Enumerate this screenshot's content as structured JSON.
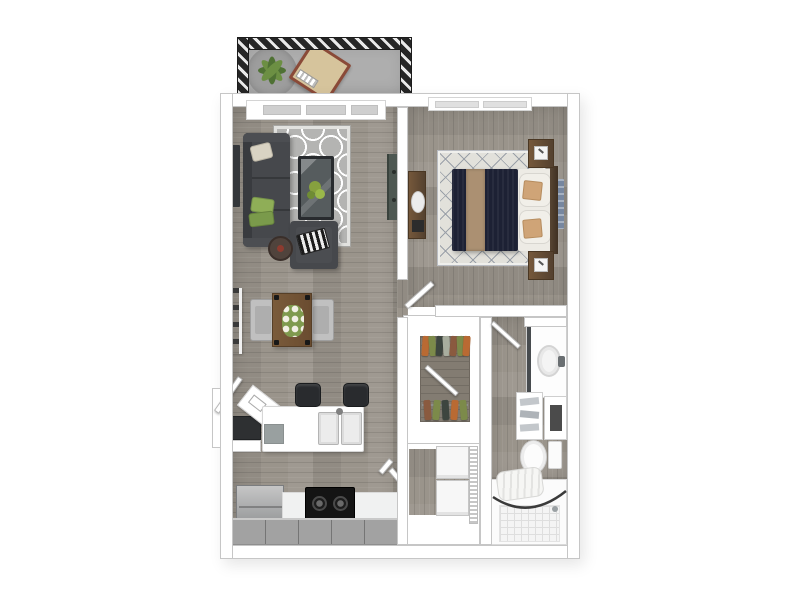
{
  "palette": {
    "wall": "#ffffff",
    "wall_line": "#c6c6c6",
    "floor_wood": "#9a948b",
    "floor_closet": "#837c72",
    "balcony_floor": "#aeaeae",
    "patio_rug": "#9d9d9d",
    "railing": "#262626",
    "railing_slash": "#e9e9e9",
    "lounge_tan": "#d6c49c",
    "lounge_frame": "#8a4a38",
    "plant_green": "#4f7134",
    "plant_green_light": "#6c8f43",
    "rug_living": "#b4b4b2",
    "rug_living_pattern": "#ffffff",
    "rug_bed": "#e2e1db",
    "rug_bed_line": "#9aa0a8",
    "sofa": "#46484c",
    "sofa_dark": "#393b3f",
    "pillow_cream": "#d9d3c3",
    "pillow_green": "#8fae57",
    "pillow_green_dark": "#7a9a4b",
    "stripe_dark": "#1b1b1b",
    "stripe_light": "#ececec",
    "glass_table": "#565c5e",
    "table_frame": "#282b2e",
    "side_table": "#50433c",
    "accent_red": "#8d3b2f",
    "tv_console": "#4e5852",
    "art_dark": "#34373b",
    "art_blue": "#7787a0",
    "wood_brown": "#75583b",
    "wood_dark": "#54412f",
    "chair_gray": "#c0c0c0",
    "duvet_navy": "#1d2134",
    "runner_tan": "#ab9072",
    "sheet_white": "#edebe5",
    "pillow_tan": "#cfa477",
    "cabinet_gray": "#a2a2a2",
    "counter_white": "#f0f1f1",
    "appliance_dark": "#141414",
    "appliance_gray": "#9fa1a3",
    "fixture": "#fbfbfb",
    "fixture_line": "#cfcfcf",
    "tile": "#f4f4f4",
    "tile_line": "#dedede",
    "towel": "#c3c7cb",
    "cloth_orange": "#b96a33",
    "cloth_green": "#7c8a4a",
    "cloth_dark": "#3d453f",
    "cloth_light": "#a8ad9e",
    "cloth_brown": "#8a5a3f",
    "rod": "#3a3a3a"
  },
  "scene": {
    "type": "3d-floor-plan-render",
    "rooms": {
      "balcony": {
        "label": "Balcony"
      },
      "living_room": {
        "label": "Living Room"
      },
      "dining_area": {
        "label": "Dining Area"
      },
      "kitchen": {
        "label": "Kitchen"
      },
      "bedroom": {
        "label": "Bedroom"
      },
      "closet": {
        "label": "Closet"
      },
      "laundry": {
        "label": "Laundry Closet"
      },
      "bathroom": {
        "label": "Bathroom"
      }
    },
    "furniture": {
      "sofa": {
        "label": "Sofa"
      },
      "accent_chair": {
        "label": "Accent Chair"
      },
      "coffee_table": {
        "label": "Coffee Table"
      },
      "side_table": {
        "label": "Side Table"
      },
      "living_rug": {
        "label": "Living Room Rug"
      },
      "media_console": {
        "label": "Media Console"
      },
      "wall_art": {
        "label": "Wall Art"
      },
      "dining_table": {
        "label": "Dining Table"
      },
      "dining_chair": {
        "label": "Dining Chair"
      },
      "ladder_shelf": {
        "label": "Ladder Shelf"
      },
      "bar_stool": {
        "label": "Bar Stool"
      },
      "kitchen_counter": {
        "label": "Kitchen Counter with Double Sink"
      },
      "refrigerator": {
        "label": "Refrigerator"
      },
      "range": {
        "label": "Range"
      },
      "base_cabinets": {
        "label": "Base Cabinets"
      },
      "bed": {
        "label": "Bed"
      },
      "nightstand": {
        "label": "Nightstand"
      },
      "dresser": {
        "label": "Dresser"
      },
      "bedroom_rug": {
        "label": "Bedroom Rug"
      },
      "hanging_clothes": {
        "label": "Hanging Clothes"
      },
      "washer_dryer": {
        "label": "Stacked Washer and Dryer"
      },
      "vanity": {
        "label": "Bathroom Vanity"
      },
      "towel_shelf": {
        "label": "Towel Shelf"
      },
      "toilet": {
        "label": "Toilet"
      },
      "bathtub": {
        "label": "Bathtub with Shower Curtain"
      },
      "patio_plant": {
        "label": "Potted Plant"
      },
      "lounge_chair": {
        "label": "Patio Lounge Chair"
      },
      "patio_rug": {
        "label": "Patio Rug"
      },
      "balcony_railing": {
        "label": "Balcony Railing"
      },
      "window": {
        "label": "Window"
      },
      "door": {
        "label": "Door"
      }
    }
  }
}
